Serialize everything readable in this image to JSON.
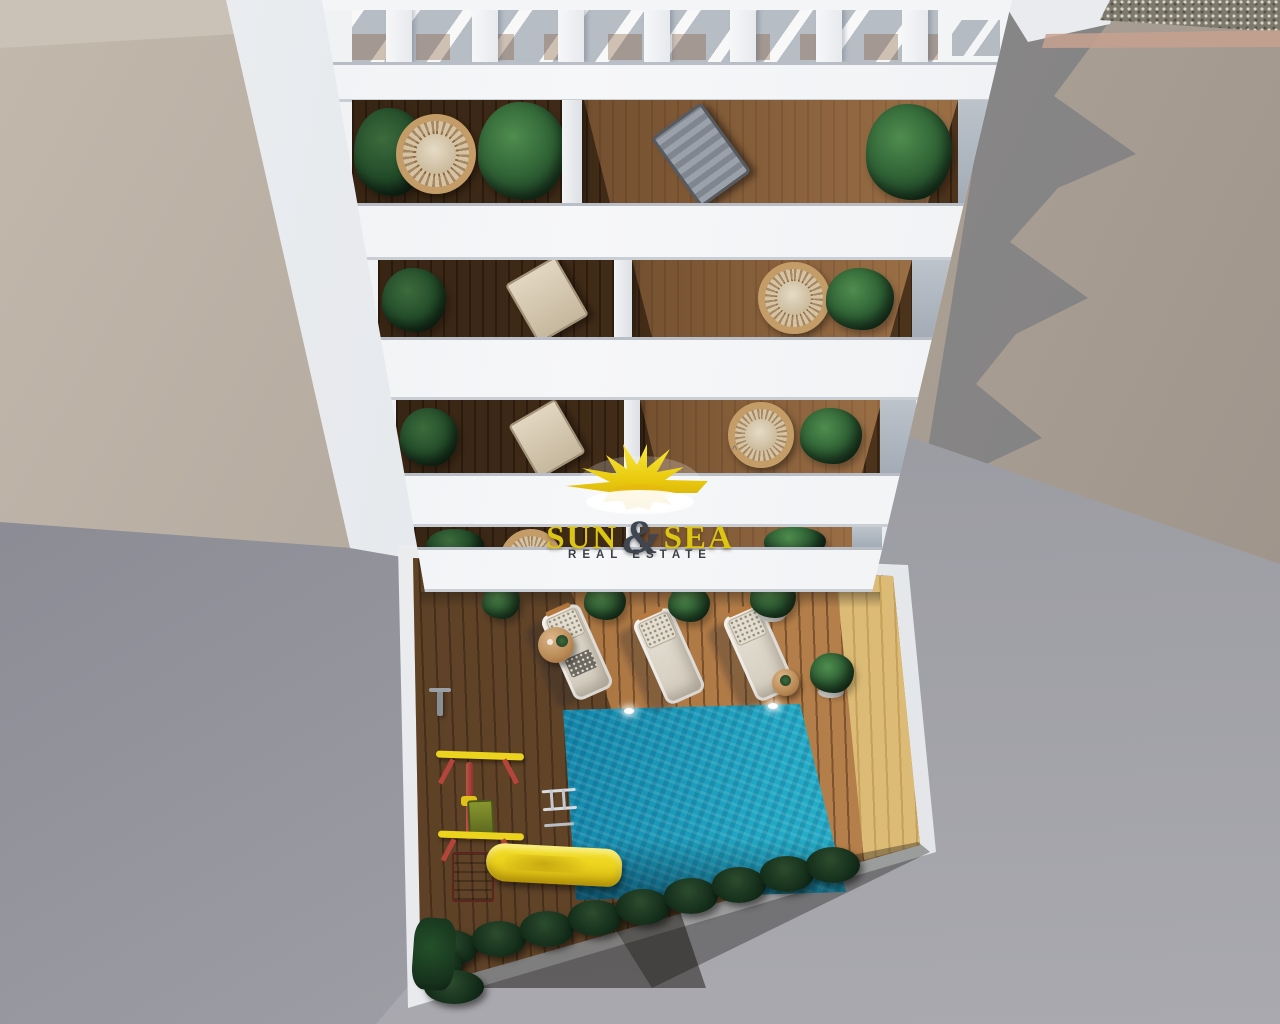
{
  "watermark": {
    "word1": "SUN",
    "ampersand": "&",
    "word2": "SEA",
    "tagline": "REAL ESTATE",
    "caret": "^",
    "icon": "sun-burst-icon"
  },
  "scene": {
    "type": "aerial-3d-architectural-render",
    "subject": "white apartment building seen from above with stacked balconies over a courtyard with swimming pool",
    "balcony_floors_visible": 4,
    "roof_pergola": true,
    "sun_loungers": 3,
    "side_tables": 2,
    "swimming_pool": true,
    "pool_ladder": true,
    "playground": [
      "yellow-slide",
      "swing-set"
    ],
    "hedge": true,
    "balcony_items": [
      "hanging-rattan-chair",
      "deck-chair",
      "potted-plants"
    ]
  },
  "colors": {
    "brand-yellow": "#dcc513",
    "sun-yellow": "#f2d713",
    "ampersand-dark": "#3f4650",
    "tagline-dark": "#3b4046",
    "building-white": "#f4f5f7",
    "wall-beige": "#b0a69b",
    "ground-gray": "#9a9aa1",
    "pool-bright": "#2cb9d0",
    "pool-dark": "#0b4a6e",
    "deck-wood": "#aa7440",
    "deck-sunlit": "#dcbb76",
    "hedge-green": "#16301c",
    "plant-green": "#2f6135",
    "rattan-tan": "#c39c68",
    "slide-yellow": "#ecd31e",
    "play-red": "#b5443a",
    "shadow-blue": "#5a6575"
  }
}
